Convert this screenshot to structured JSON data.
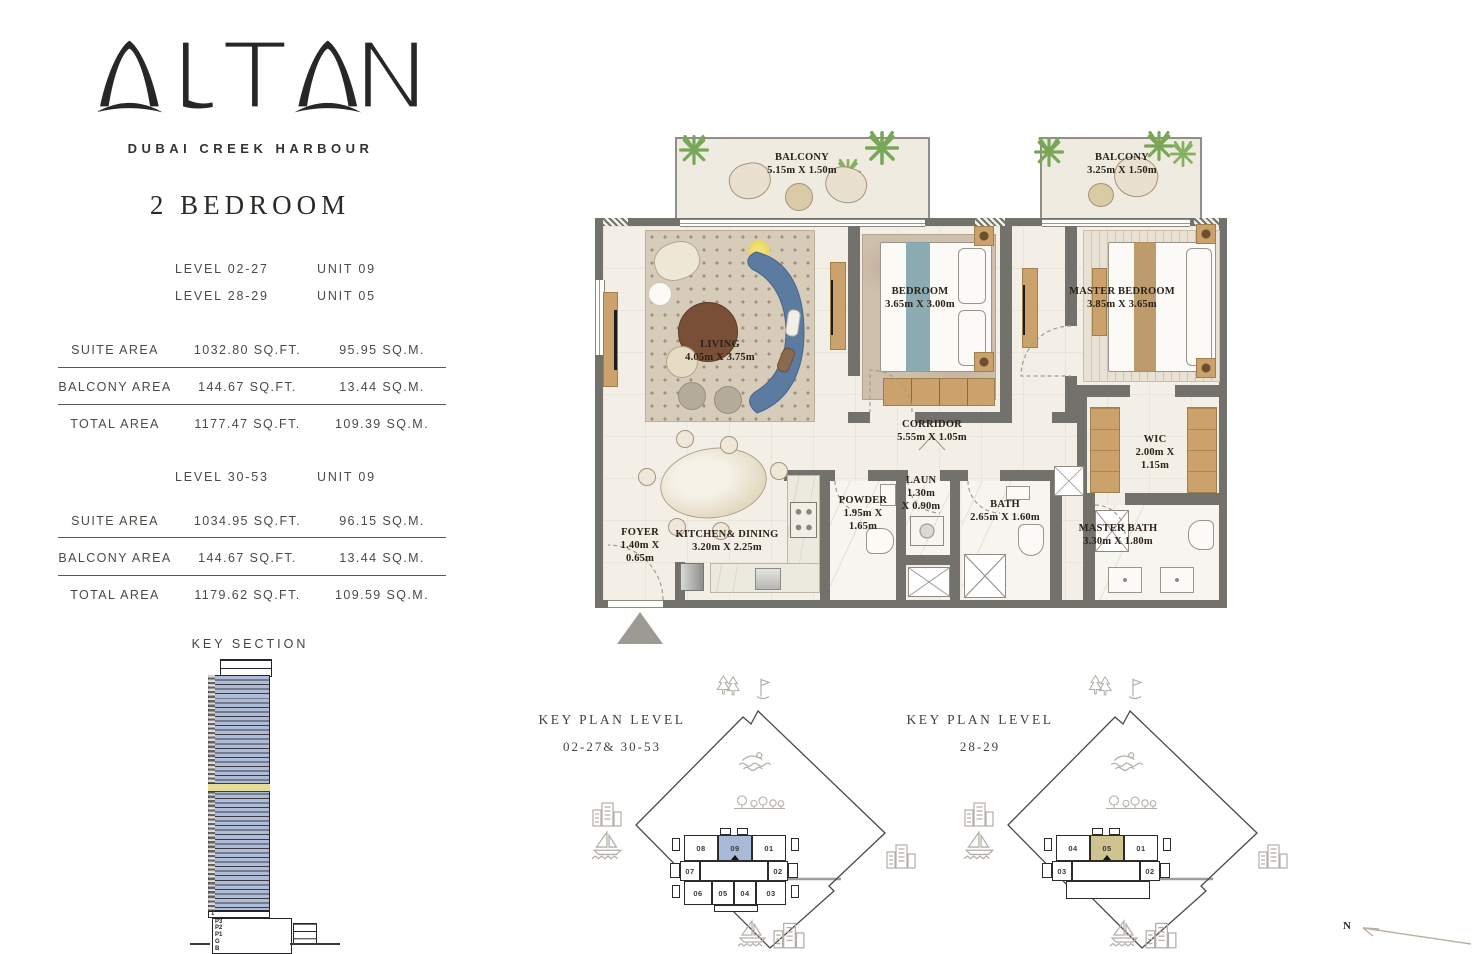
{
  "brand": {
    "logo_text": "ALTAN",
    "subtitle": "DUBAI CREEK HARBOUR"
  },
  "plan_title": "2 BEDROOM",
  "unit_levels_a": {
    "rows": [
      {
        "level": "LEVEL 02-27",
        "unit": "UNIT 09"
      },
      {
        "level": "LEVEL 28-29",
        "unit": "UNIT 05"
      }
    ]
  },
  "area_table_a": {
    "rows": [
      {
        "label": "SUITE AREA",
        "sqft": "1032.80 SQ.FT.",
        "sqm": "95.95 SQ.M."
      },
      {
        "label": "BALCONY AREA",
        "sqft": "144.67 SQ.FT.",
        "sqm": "13.44 SQ.M."
      },
      {
        "label": "TOTAL AREA",
        "sqft": "1177.47 SQ.FT.",
        "sqm": "109.39 SQ.M."
      }
    ]
  },
  "unit_levels_b": {
    "rows": [
      {
        "level": "LEVEL 30-53",
        "unit": "UNIT 09"
      }
    ]
  },
  "area_table_b": {
    "rows": [
      {
        "label": "SUITE AREA",
        "sqft": "1034.95 SQ.FT.",
        "sqm": "96.15 SQ.M."
      },
      {
        "label": "BALCONY AREA",
        "sqft": "144.67 SQ.FT.",
        "sqm": "13.44 SQ.M."
      },
      {
        "label": "TOTAL AREA",
        "sqft": "1179.62 SQ.FT.",
        "sqm": "109.59 SQ.M."
      }
    ]
  },
  "key_section": {
    "title": "KEY SECTION",
    "ground_floor_label": "1",
    "podium_labels": [
      "P3",
      "P2",
      "P1",
      "G",
      "B"
    ],
    "tower_color": "#aebcd8",
    "highlight_band_color": "#e5dc99"
  },
  "floor_plan": {
    "rooms": {
      "balcony1": {
        "name": "BALCONY",
        "d1": "5.15m X 1.50m"
      },
      "balcony2": {
        "name": "BALCONY",
        "d1": "3.25m X 1.50m"
      },
      "living": {
        "name": "LIVING",
        "d1": "4.05m X 3.75m"
      },
      "bedroom": {
        "name": "BEDROOM",
        "d1": "3.65m X 3.00m"
      },
      "master_bedroom": {
        "name": "MASTER BEDROOM",
        "d1": "3.85m X 3.65m"
      },
      "corridor": {
        "name": "CORRIDOR",
        "d1": "5.55m X 1.05m"
      },
      "wic": {
        "name": "WIC",
        "d1": "2.00m X",
        "d2": "1.15m"
      },
      "powder": {
        "name": "POWDER",
        "d1": "1.95m X",
        "d2": "1.65m"
      },
      "laun": {
        "name": "LAUN",
        "d1": "1.30m",
        "d2": "X 0.90m"
      },
      "bath": {
        "name": "BATH",
        "d1": "2.65m X 1.60m"
      },
      "foyer": {
        "name": "FOYER",
        "d1": "1.40m X",
        "d2": "0.65m"
      },
      "kitchen": {
        "name": "KITCHEN& DINING",
        "d1": "3.20m X 2.25m"
      },
      "master_bath": {
        "name": "MASTER BATH",
        "d1": "3.30m X 1.80m"
      }
    },
    "colors": {
      "wall": "#73716c",
      "floor": "#f3efe7",
      "sofa": "#5b7ba1",
      "wood": "#cba26b"
    }
  },
  "key_plans": [
    {
      "title": "KEY PLAN LEVEL",
      "subtitle": "02-27& 30-53",
      "units_top": [
        "08",
        "09",
        "01"
      ],
      "units_mid": [
        "07",
        "02"
      ],
      "units_bottom": [
        "06",
        "05",
        "04",
        "03"
      ],
      "highlight_unit": "09",
      "highlight_color": "#a9bad9"
    },
    {
      "title": "KEY PLAN LEVEL",
      "subtitle": "28-29",
      "units_top": [
        "04",
        "05",
        "01"
      ],
      "units_mid": [
        "03",
        "02"
      ],
      "units_bottom": [],
      "highlight_unit": "05",
      "highlight_color": "#cfc48f"
    }
  ],
  "compass": {
    "label": "N"
  }
}
